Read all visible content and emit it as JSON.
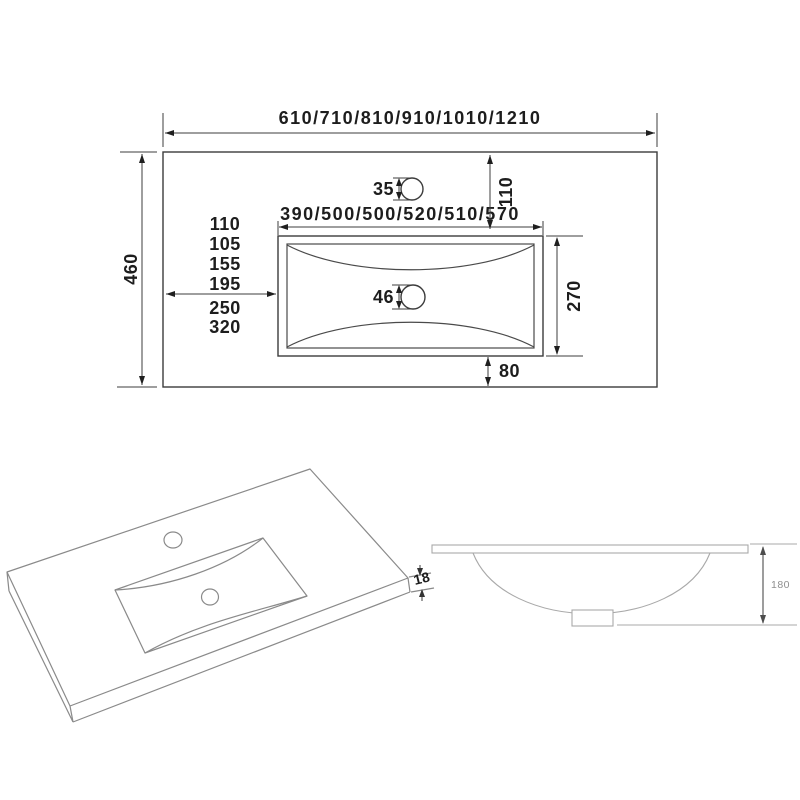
{
  "plan_view": {
    "overall_width_options": "610/710/810/910/1010/1210",
    "overall_depth": "460",
    "basin_width_options": "390/500/500/520/510/570",
    "faucet_hole_diameter": "35",
    "faucet_zone_depth": "110",
    "basin_left_offsets": [
      "110",
      "105",
      "155",
      "195",
      "250",
      "320"
    ],
    "drain_hole_diameter": "46",
    "basin_depth": "270",
    "basin_to_front_edge": "80"
  },
  "isometric_view": {
    "countertop_thickness": "18"
  },
  "section_view": {
    "basin_height": "180"
  },
  "colors": {
    "line_dark": "#3c3c3c",
    "line_iso": "#8a8a8a",
    "line_section": "#a9a9a9",
    "text_dark": "#1d1d1d",
    "text_section": "#8f8f8f",
    "background": "#ffffff"
  }
}
